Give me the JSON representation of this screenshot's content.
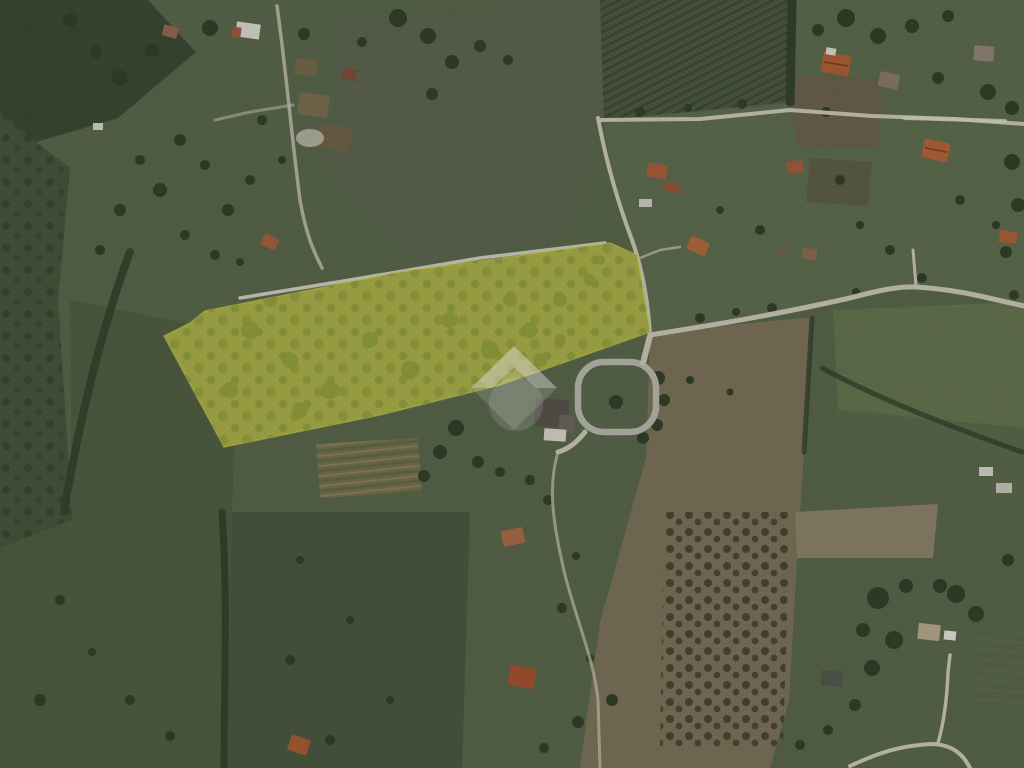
{
  "image": {
    "kind": "aerial-satellite-photograph",
    "scene": "Rural countryside: green meadows, olive groves, vineyard fields with row stripes, tan plowed fields with scattered trees, red-roofed farmhouses, a villa with circular driveway, and winding light gravel roads",
    "highlight": "Elongated irregular land parcel highlighted in translucent yellow, left of center, dotted with olive trees",
    "watermark": "Translucent white diamond house-logo watermark centered under the parcel"
  },
  "parcel": {
    "points": "610,243 637,255 650,332 500,385 380,415 224,447 164,336 190,323 205,311 400,272",
    "fill": "#a9ae4a",
    "stroke": "#c6ca45",
    "tree_color": "#8f9d3f"
  },
  "watermark": {
    "color": "#ffffff",
    "diamond_points": "514,346 557,388 514,430 471,388",
    "roof_path": "M514,346 L557,388 L536,388 L514,367 L492,388 L471,388 Z"
  },
  "palette": {
    "base_green": "#59664b",
    "forest": "#3c4a35",
    "meadow": "#505d42",
    "plowed_tan": "#7b7259",
    "vineyard_dark": "#4c5841",
    "road": "#c8c4b4",
    "roof_red": "#ad6037"
  }
}
